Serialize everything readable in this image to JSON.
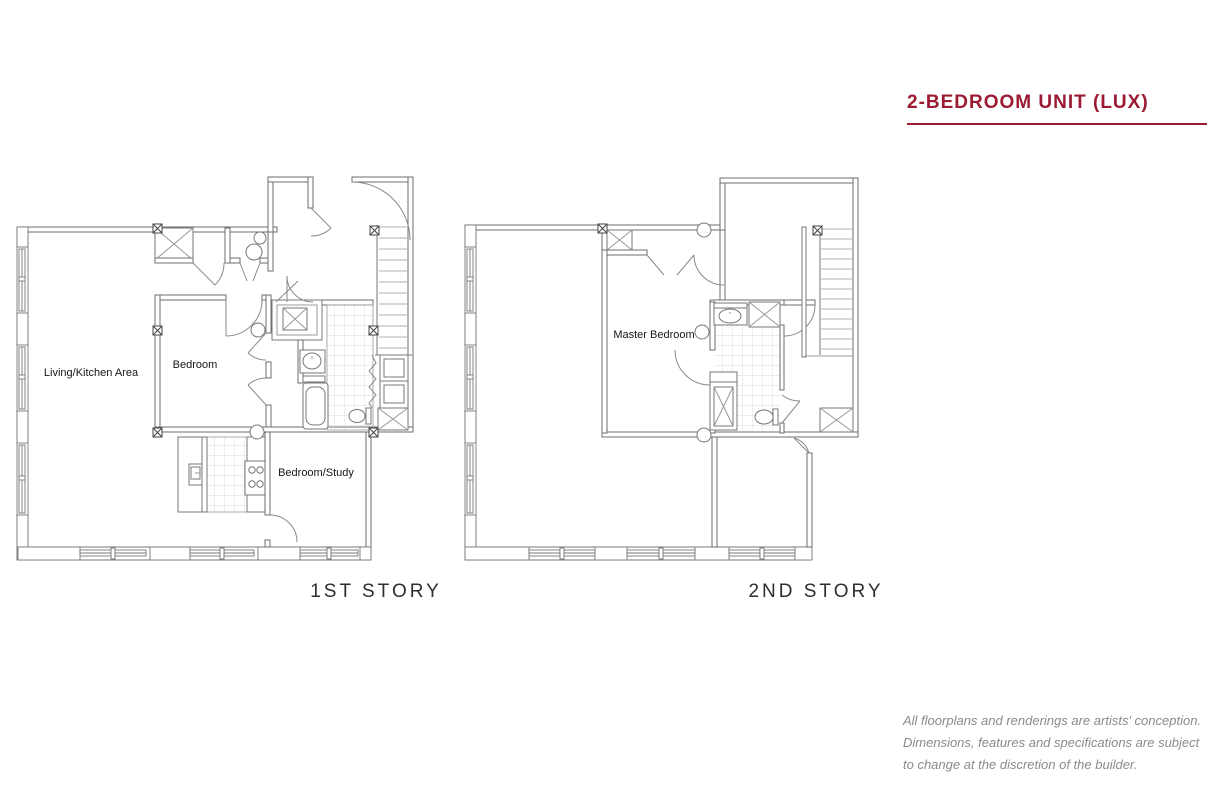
{
  "header": {
    "title": "2-BEDROOM UNIT (LUX)",
    "accent_color": "#9B1B33"
  },
  "floorplans": [
    {
      "id": "first-story",
      "caption": "1ST STORY",
      "rooms": [
        {
          "label": "Living/Kitchen Area"
        },
        {
          "label": "Bedroom"
        },
        {
          "label": "Bedroom/Study"
        }
      ]
    },
    {
      "id": "second-story",
      "caption": "2ND STORY",
      "rooms": [
        {
          "label": "Master Bedroom"
        }
      ]
    }
  ],
  "disclaimer": {
    "lines": [
      "All floorplans and renderings are artists' conception.",
      "Dimensions, features and specifications are subject",
      "to change at the discretion of the builder."
    ]
  },
  "palette": {
    "wall_line": "#6e6e6e",
    "fixture_line": "#777777",
    "tile_line": "#cfcfcf",
    "stair_tread": "#b0b0b0",
    "door_arc": "#8a8a8a",
    "caption_text": "#2e2e2e",
    "disclaimer_text": "#8b8b8b"
  }
}
